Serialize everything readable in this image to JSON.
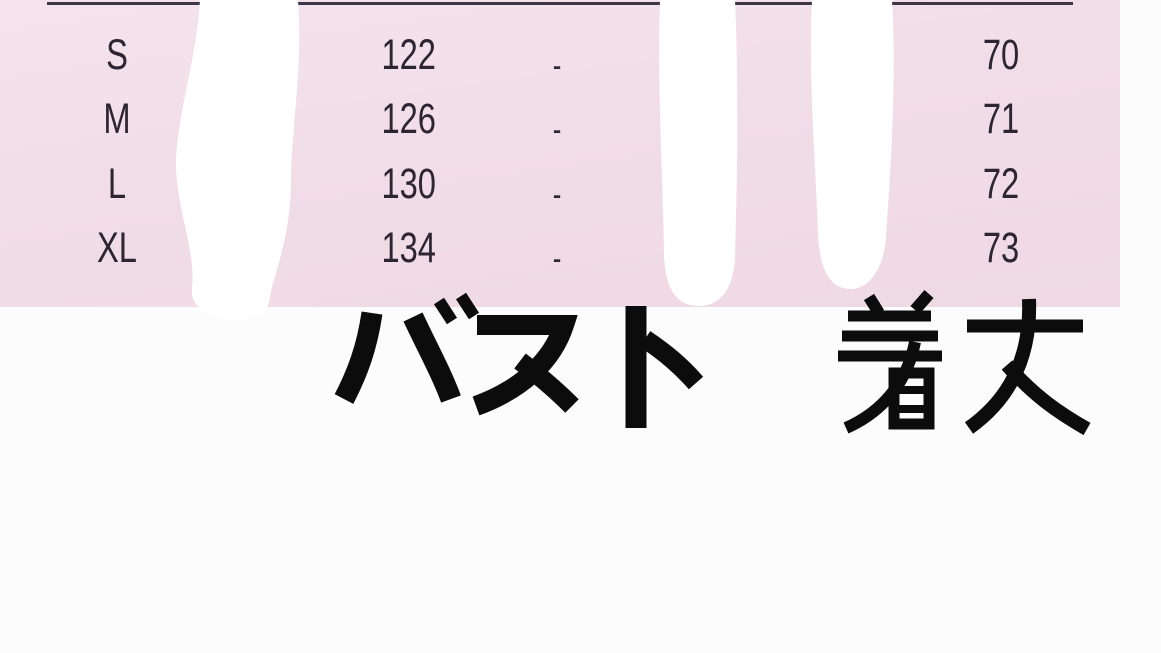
{
  "page": {
    "background": "#fcfcfd"
  },
  "size_table": {
    "panel_color": "#f0dce7",
    "top_border_color": "#3e3644",
    "text_color": "#2d2531",
    "erasure_color": "#ffffff",
    "rows": [
      {
        "size": "S",
        "bust": "122",
        "col3": "-",
        "length": "70"
      },
      {
        "size": "M",
        "bust": "126",
        "col3": "-",
        "length": "71"
      },
      {
        "size": "L",
        "bust": "130",
        "col3": "-",
        "length": "72"
      },
      {
        "size": "XL",
        "bust": "134",
        "col3": "-",
        "length": "73"
      }
    ]
  },
  "caption": {
    "bust_label": "バスト",
    "length_label": "着丈",
    "text_color": "#0c0c0c"
  },
  "chart_data": {
    "type": "table",
    "title": "Garment size chart",
    "row_labels": [
      "S",
      "M",
      "L",
      "XL"
    ],
    "series": [
      {
        "name": "バスト",
        "values": [
          122,
          126,
          130,
          134
        ]
      },
      {
        "name": "unlabeled-column",
        "values": [
          "-",
          "-",
          "-",
          "-"
        ]
      },
      {
        "name": "着丈",
        "values": [
          70,
          71,
          72,
          73
        ]
      }
    ],
    "notes": "Pink table panel with thin dark top rule; two header/column areas are painted over with white strokes; the large black labels バスト (bust) and 着丈 (length) are printed below the panel."
  }
}
